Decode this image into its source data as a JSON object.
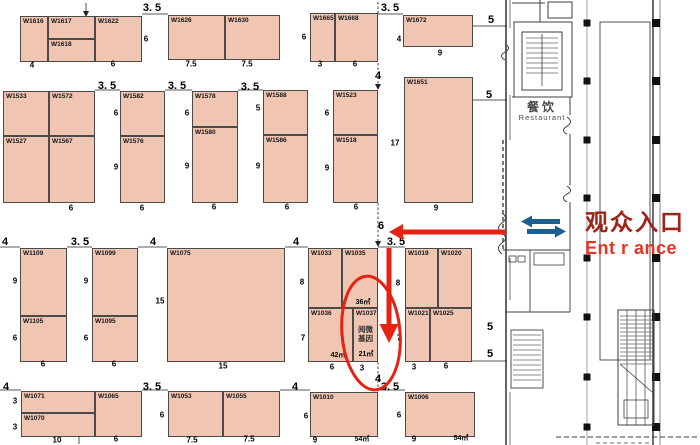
{
  "palette": {
    "booth_fill": "#f0c5b2",
    "booth_border": "#4a4a4a",
    "highlight_red": "#e42313",
    "entrance_dark_red": "#9e2318",
    "entrance_red": "#e23525",
    "direction_blue": "#1d5f93",
    "plan_gray": "#3f3f3f"
  },
  "entrance": {
    "cn": "观众入口",
    "en": "Ent r ance"
  },
  "restaurant": {
    "cn": "餐饮",
    "en": "Restaurant"
  },
  "highlight": {
    "booth_id": "W1037",
    "company": "阅微基因",
    "area": "21㎡"
  },
  "booths": [
    {
      "id": "W1616",
      "x": 20,
      "y": 16,
      "w": 28,
      "h": 46
    },
    {
      "id": "W1617",
      "x": 48,
      "y": 16,
      "w": 47,
      "h": 23
    },
    {
      "id": "W1618",
      "x": 48,
      "y": 39,
      "w": 47,
      "h": 23
    },
    {
      "id": "W1622",
      "x": 95,
      "y": 16,
      "w": 47,
      "h": 46
    },
    {
      "id": "W1626",
      "x": 168,
      "y": 15,
      "w": 57,
      "h": 45
    },
    {
      "id": "W1630",
      "x": 225,
      "y": 15,
      "w": 55,
      "h": 45
    },
    {
      "id": "W1665",
      "x": 310,
      "y": 13,
      "w": 25,
      "h": 49
    },
    {
      "id": "W1668",
      "x": 335,
      "y": 13,
      "w": 43,
      "h": 49
    },
    {
      "id": "W1672",
      "x": 403,
      "y": 15,
      "w": 70,
      "h": 32
    },
    {
      "id": "W1533",
      "x": 3,
      "y": 91,
      "w": 46,
      "h": 45
    },
    {
      "id": "W1572",
      "x": 49,
      "y": 91,
      "w": 46,
      "h": 45
    },
    {
      "id": "W1527",
      "x": 3,
      "y": 136,
      "w": 46,
      "h": 67
    },
    {
      "id": "W1567",
      "x": 49,
      "y": 136,
      "w": 46,
      "h": 67
    },
    {
      "id": "W1582",
      "x": 120,
      "y": 91,
      "w": 45,
      "h": 45
    },
    {
      "id": "W1576",
      "x": 120,
      "y": 136,
      "w": 45,
      "h": 67
    },
    {
      "id": "W1578",
      "x": 192,
      "y": 91,
      "w": 46,
      "h": 36
    },
    {
      "id": "W1580",
      "x": 192,
      "y": 127,
      "w": 46,
      "h": 76
    },
    {
      "id": "W1588",
      "x": 263,
      "y": 90,
      "w": 45,
      "h": 45
    },
    {
      "id": "W1586",
      "x": 263,
      "y": 135,
      "w": 45,
      "h": 68
    },
    {
      "id": "W1523",
      "x": 333,
      "y": 90,
      "w": 45,
      "h": 45
    },
    {
      "id": "W1518",
      "x": 333,
      "y": 135,
      "w": 45,
      "h": 68
    },
    {
      "id": "W1651",
      "x": 404,
      "y": 77,
      "w": 69,
      "h": 126
    },
    {
      "id": "W1109",
      "x": 20,
      "y": 248,
      "w": 47,
      "h": 68
    },
    {
      "id": "W1105",
      "x": 20,
      "y": 316,
      "w": 47,
      "h": 46
    },
    {
      "id": "W1099",
      "x": 92,
      "y": 248,
      "w": 46,
      "h": 68
    },
    {
      "id": "W1095",
      "x": 92,
      "y": 316,
      "w": 46,
      "h": 46
    },
    {
      "id": "W1075",
      "x": 167,
      "y": 248,
      "w": 118,
      "h": 114
    },
    {
      "id": "W1033",
      "x": 308,
      "y": 248,
      "w": 34,
      "h": 60
    },
    {
      "id": "W1035",
      "x": 342,
      "y": 248,
      "w": 36,
      "h": 60
    },
    {
      "id": "W1036",
      "x": 308,
      "y": 308,
      "w": 45,
      "h": 54
    },
    {
      "id": "W1037",
      "x": 353,
      "y": 308,
      "w": 25,
      "h": 54,
      "company": [
        "阅微",
        "基因"
      ]
    },
    {
      "id": "W1019",
      "x": 405,
      "y": 248,
      "w": 33,
      "h": 60
    },
    {
      "id": "W1020",
      "x": 438,
      "y": 248,
      "w": 34,
      "h": 60
    },
    {
      "id": "W1021",
      "x": 405,
      "y": 308,
      "w": 25,
      "h": 54
    },
    {
      "id": "W1025",
      "x": 430,
      "y": 308,
      "w": 42,
      "h": 54
    },
    {
      "id": "W1071",
      "x": 21,
      "y": 391,
      "w": 74,
      "h": 22
    },
    {
      "id": "W1070",
      "x": 21,
      "y": 413,
      "w": 74,
      "h": 24
    },
    {
      "id": "W1065",
      "x": 95,
      "y": 391,
      "w": 47,
      "h": 46
    },
    {
      "id": "W1053",
      "x": 168,
      "y": 391,
      "w": 55,
      "h": 46
    },
    {
      "id": "W1055",
      "x": 223,
      "y": 391,
      "w": 57,
      "h": 46
    },
    {
      "id": "W1010",
      "x": 310,
      "y": 392,
      "w": 68,
      "h": 45
    },
    {
      "id": "W1006",
      "x": 405,
      "y": 392,
      "w": 70,
      "h": 45
    }
  ],
  "dimensions": [
    {
      "t": "3. 5",
      "x": 152,
      "y": 8,
      "b": 1
    },
    {
      "t": "3. 5",
      "x": 390,
      "y": 8,
      "b": 1
    },
    {
      "t": "4",
      "x": 32,
      "y": 65
    },
    {
      "t": "6",
      "x": 113,
      "y": 64
    },
    {
      "t": "6",
      "x": 146,
      "y": 39
    },
    {
      "t": "7.5",
      "x": 191,
      "y": 64
    },
    {
      "t": "7.5",
      "x": 247,
      "y": 64
    },
    {
      "t": "6",
      "x": 304,
      "y": 37
    },
    {
      "t": "3",
      "x": 320,
      "y": 64
    },
    {
      "t": "6",
      "x": 355,
      "y": 64
    },
    {
      "t": "4",
      "x": 399,
      "y": 39
    },
    {
      "t": "9",
      "x": 440,
      "y": 53
    },
    {
      "t": "5",
      "x": 491,
      "y": 20,
      "b": 1
    },
    {
      "t": "3. 5",
      "x": 107,
      "y": 86,
      "b": 1
    },
    {
      "t": "3. 5",
      "x": 177,
      "y": 86,
      "b": 1
    },
    {
      "t": "3. 5",
      "x": 250,
      "y": 87,
      "b": 1
    },
    {
      "t": "4",
      "x": 378,
      "y": 76,
      "b": 1
    },
    {
      "t": "6",
      "x": 71,
      "y": 208
    },
    {
      "t": "6",
      "x": 116,
      "y": 113
    },
    {
      "t": "9",
      "x": 116,
      "y": 167
    },
    {
      "t": "6",
      "x": 142,
      "y": 208
    },
    {
      "t": "6",
      "x": 187,
      "y": 113
    },
    {
      "t": "9",
      "x": 187,
      "y": 166
    },
    {
      "t": "6",
      "x": 214,
      "y": 207
    },
    {
      "t": "5",
      "x": 258,
      "y": 108
    },
    {
      "t": "9",
      "x": 258,
      "y": 166
    },
    {
      "t": "6",
      "x": 287,
      "y": 207
    },
    {
      "t": "6",
      "x": 327,
      "y": 113
    },
    {
      "t": "9",
      "x": 327,
      "y": 168
    },
    {
      "t": "6",
      "x": 356,
      "y": 207
    },
    {
      "t": "17",
      "x": 395,
      "y": 143
    },
    {
      "t": "9",
      "x": 436,
      "y": 208
    },
    {
      "t": "5",
      "x": 489,
      "y": 95,
      "b": 1
    },
    {
      "t": "6",
      "x": 381,
      "y": 226,
      "b": 1
    },
    {
      "t": "3. 5",
      "x": 396,
      "y": 242,
      "b": 1
    },
    {
      "t": "4",
      "x": 5,
      "y": 242,
      "b": 1
    },
    {
      "t": "3. 5",
      "x": 80,
      "y": 242,
      "b": 1
    },
    {
      "t": "4",
      "x": 153,
      "y": 242,
      "b": 1
    },
    {
      "t": "4",
      "x": 296,
      "y": 242,
      "b": 1
    },
    {
      "t": "9",
      "x": 15,
      "y": 281
    },
    {
      "t": "6",
      "x": 15,
      "y": 338
    },
    {
      "t": "6",
      "x": 43,
      "y": 364
    },
    {
      "t": "9",
      "x": 86,
      "y": 281
    },
    {
      "t": "6",
      "x": 86,
      "y": 338
    },
    {
      "t": "6",
      "x": 114,
      "y": 364
    },
    {
      "t": "15",
      "x": 160,
      "y": 301
    },
    {
      "t": "15",
      "x": 223,
      "y": 366
    },
    {
      "t": "8",
      "x": 302,
      "y": 282
    },
    {
      "t": "7",
      "x": 303,
      "y": 338
    },
    {
      "t": "6",
      "x": 332,
      "y": 367
    },
    {
      "t": "3",
      "x": 362,
      "y": 368
    },
    {
      "t": "8",
      "x": 398,
      "y": 283
    },
    {
      "t": "7",
      "x": 399,
      "y": 338
    },
    {
      "t": "3",
      "x": 414,
      "y": 367
    },
    {
      "t": "6",
      "x": 446,
      "y": 366
    },
    {
      "t": "5",
      "x": 490,
      "y": 327,
      "b": 1
    },
    {
      "t": "5",
      "x": 490,
      "y": 354,
      "b": 1
    },
    {
      "t": "4",
      "x": 6,
      "y": 387,
      "b": 1
    },
    {
      "t": "3. 5",
      "x": 152,
      "y": 387,
      "b": 1
    },
    {
      "t": "4",
      "x": 295,
      "y": 387,
      "b": 1
    },
    {
      "t": "3. 5",
      "x": 390,
      "y": 387,
      "b": 1
    },
    {
      "t": "4",
      "x": 378,
      "y": 379,
      "b": 1
    },
    {
      "t": "3",
      "x": 15,
      "y": 401
    },
    {
      "t": "3",
      "x": 15,
      "y": 427
    },
    {
      "t": "10",
      "x": 57,
      "y": 440
    },
    {
      "t": "6",
      "x": 116,
      "y": 439
    },
    {
      "t": "6",
      "x": 162,
      "y": 415
    },
    {
      "t": "7.5",
      "x": 192,
      "y": 440
    },
    {
      "t": "7.5",
      "x": 249,
      "y": 439
    },
    {
      "t": "6",
      "x": 306,
      "y": 416
    },
    {
      "t": "9",
      "x": 315,
      "y": 440
    },
    {
      "t": "6",
      "x": 399,
      "y": 415
    },
    {
      "t": "9",
      "x": 414,
      "y": 439
    }
  ],
  "area_labels": [
    {
      "t": "36㎡",
      "x": 363,
      "y": 302
    },
    {
      "t": "42㎡",
      "x": 338,
      "y": 355
    },
    {
      "t": "21㎡",
      "x": 366,
      "y": 354
    },
    {
      "t": "54㎡",
      "x": 362,
      "y": 439
    },
    {
      "t": "54㎡",
      "x": 461,
      "y": 438
    }
  ]
}
